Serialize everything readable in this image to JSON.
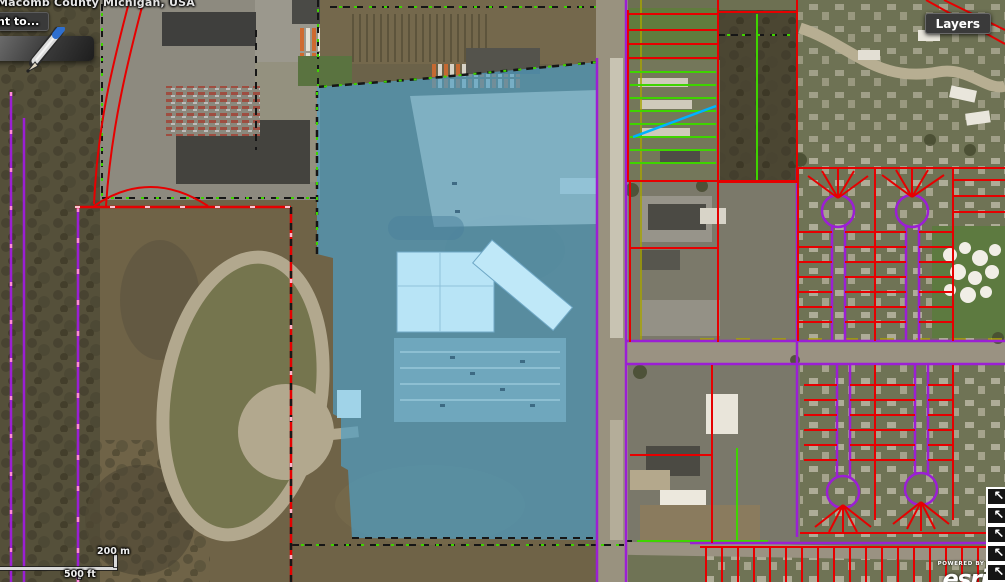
{
  "attribution": {
    "text": "Macomb County Michigan, USA"
  },
  "popup": {
    "truncated_button_label": "nt to..."
  },
  "layers_button": {
    "label": "Layers"
  },
  "scale_bar": {
    "metric_label": "200 m",
    "imperial_label": "500 ft"
  },
  "esri_attribution": {
    "powered_by": "POWERED BY",
    "dot": "●",
    "logo": "esri"
  },
  "cursor_stack": {
    "arrow_glyph": "↖",
    "count": 5
  },
  "icons": {
    "pencil": "pencil-icon",
    "cursor_arrow": "northwest-arrow-icon"
  },
  "colors": {
    "parcel_highlight": "#4f9ec4",
    "boundary_red": "#e60000",
    "boundary_purple": "#9b1fd4",
    "boundary_green": "#3fd400",
    "boundary_cyan": "#00b2ff",
    "boundary_black_dash": "#161616",
    "boundary_pink_dash": "#ff8ad8",
    "road_gray": "#9a9282",
    "track_pavement": "#b2a88e",
    "button_bg": "#3a3a3a",
    "button_text": "#ffffff"
  }
}
